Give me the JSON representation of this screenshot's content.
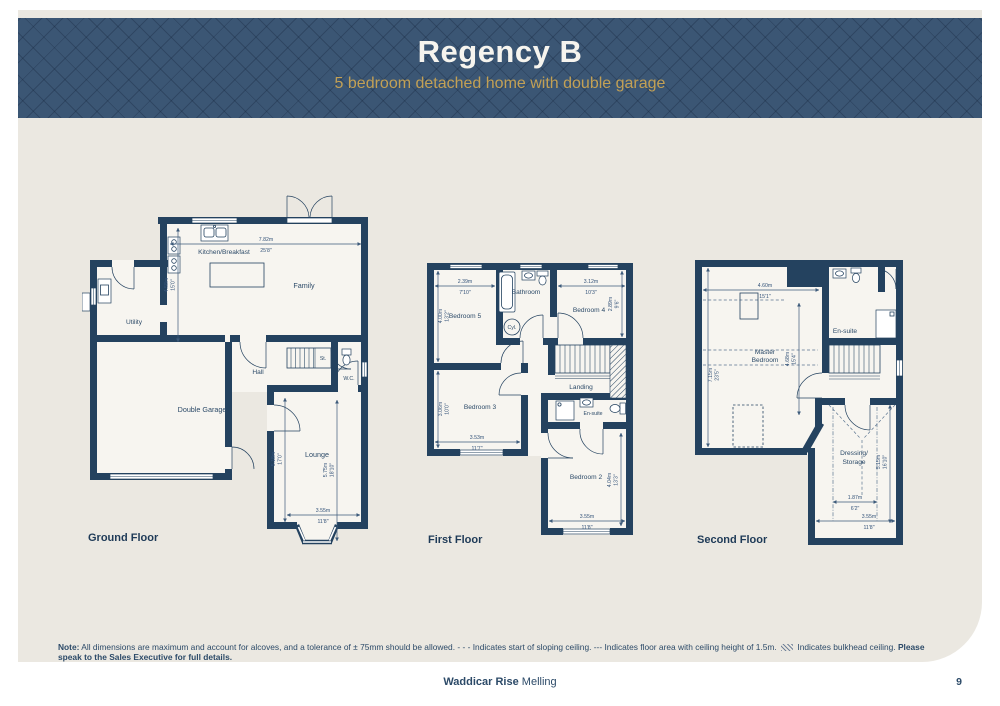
{
  "header": {
    "title": "Regency B",
    "subtitle": "5 bedroom detached home with double garage"
  },
  "floors": {
    "ground": {
      "title": "Ground Floor",
      "rooms": {
        "kitchen": "Kitchen/Breakfast",
        "family": "Family",
        "utility": "Utility",
        "hall": "Hall",
        "store": "St.",
        "wc": "W.C.",
        "garage": "Double Garage",
        "lounge": "Lounge"
      },
      "dims": {
        "width": {
          "m": "7.82m",
          "ft": "25'8\""
        },
        "depth": {
          "m": "4.58m",
          "ft": "15'0\""
        },
        "lounge_depth": {
          "m": "5.18m",
          "ft": "17'0\""
        },
        "lounge_depth_bay": {
          "m": "5.75m",
          "ft": "18'10\""
        },
        "lounge_width": {
          "m": "3.55m",
          "ft": "11'8\""
        }
      }
    },
    "first": {
      "title": "First Floor",
      "rooms": {
        "bedroom5": "Bedroom 5",
        "bathroom": "Bathroom",
        "bedroom4": "Bedroom 4",
        "cyl": "Cyl.",
        "landing": "Landing",
        "bedroom3": "Bedroom 3",
        "ensuite": "En-suite",
        "bedroom2": "Bedroom 2"
      },
      "dims": {
        "bed5_w": {
          "m": "2.39m",
          "ft": "7'10\""
        },
        "bed5_d": {
          "m": "4.00m",
          "ft": "13'2\""
        },
        "bed4_w": {
          "m": "3.12m",
          "ft": "10'3\""
        },
        "bed4_d": {
          "m": "2.89m",
          "ft": "9'6\""
        },
        "bed3_w": {
          "m": "3.53m",
          "ft": "11'7\""
        },
        "bed3_d": {
          "m": "3.06m",
          "ft": "10'0\""
        },
        "bed2_w": {
          "m": "3.55m",
          "ft": "11'8\""
        },
        "bed2_d": {
          "m": "4.04m",
          "ft": "13'3\""
        }
      }
    },
    "second": {
      "title": "Second Floor",
      "rooms": {
        "master_line1": "Master",
        "master_line2": "Bedroom",
        "ensuite": "En-suite",
        "dressing_line1": "Dressing/",
        "dressing_line2": "Storage"
      },
      "dims": {
        "master_w": {
          "m": "4.60m",
          "ft": "15'1\""
        },
        "master_d": {
          "m": "4.68m",
          "ft": "15'4\""
        },
        "overall_d": {
          "m": "7.15m",
          "ft": "23'5\""
        },
        "dress_w": {
          "m": "1.87m",
          "ft": "6'2\""
        },
        "dress_d": {
          "m": "5.15m",
          "ft": "16'10\""
        },
        "dress_w2": {
          "m": "3.55m",
          "ft": "11'8\""
        }
      }
    }
  },
  "note": {
    "label": "Note:",
    "text": "All dimensions are maximum and account for alcoves, and a tolerance of ± 75mm should be allowed.",
    "sloping": "- - - Indicates start of sloping ceiling.",
    "ceiling": "--- Indicates floor area with ceiling height of 1.5m.",
    "bulkhead": "Indicates bulkhead ceiling.",
    "bold": "Please speak to the Sales Executive for full details."
  },
  "footer": {
    "development": "Waddicar Rise",
    "location": "Melling",
    "page": "9"
  }
}
